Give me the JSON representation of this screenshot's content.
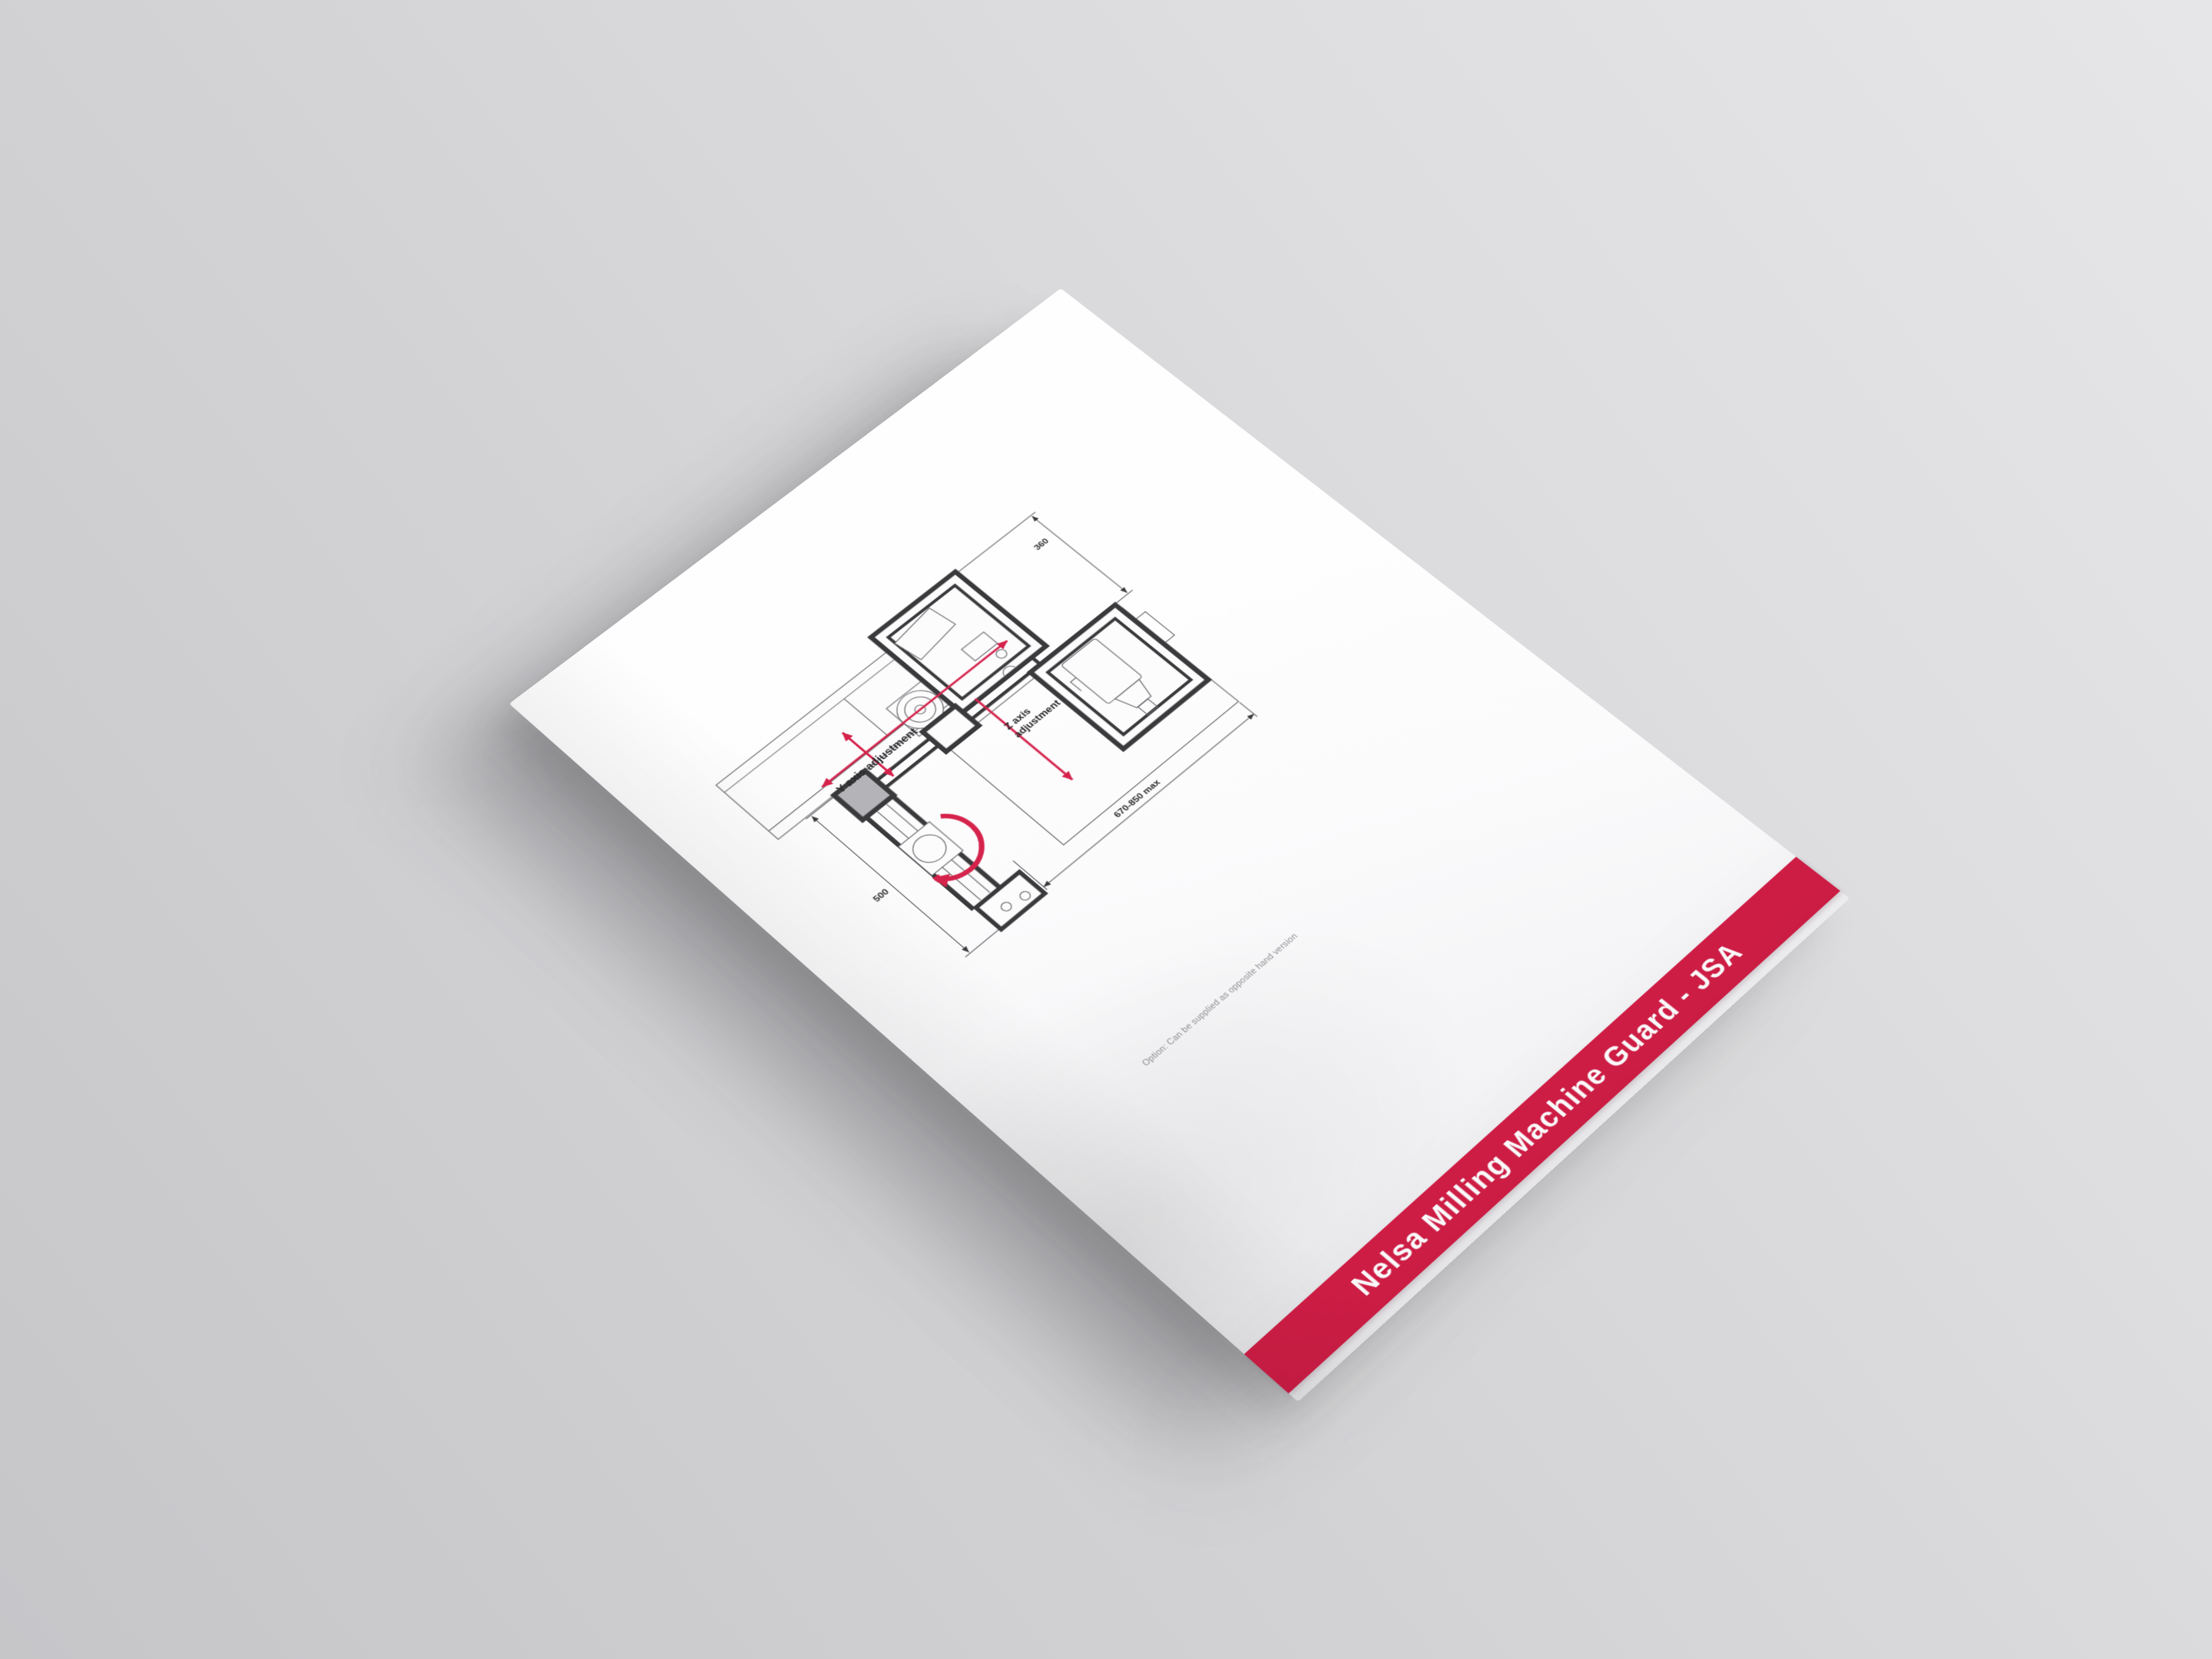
{
  "banner": {
    "title": "Nelsa Milling Machine Guard - JSA",
    "background_color": "#d21e47",
    "text_color": "#ffffff"
  },
  "caption": {
    "text": "Option: Can be supplied as opposite hand version"
  },
  "diagram": {
    "labels": {
      "y_axis": "Y axis adjustment",
      "z_axis_line1": "Z axis",
      "z_axis_line2": "adjustment"
    },
    "dimensions": {
      "guard_width": "360",
      "arm_length": "500",
      "reach": "670-850 max"
    },
    "icons": {
      "y_axis_arrow": "double-headed-arrow",
      "slide_arrow": "double-headed-arrow",
      "z_axis_arrow": "down-arrow",
      "rotation_arrow": "curved-arrow"
    },
    "colors": {
      "accent_red": "#d5234c",
      "guard_line": "#3a3a3c",
      "machine_line": "#6b6b6f",
      "column_fill": "#b4b4b8"
    }
  }
}
